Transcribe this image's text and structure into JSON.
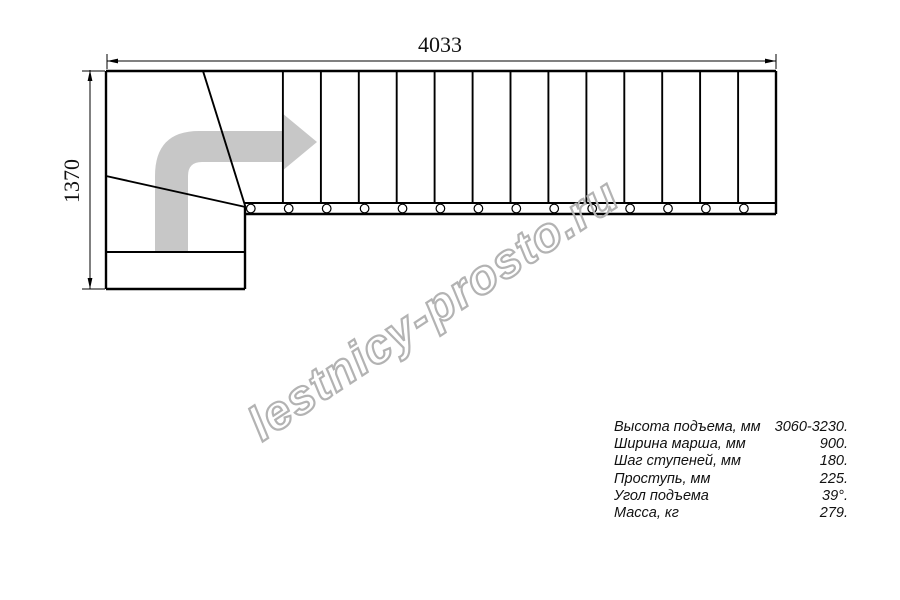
{
  "drawing": {
    "dim_width_label": "4033",
    "dim_height_label": "1370",
    "straight_steps": 14,
    "winder_steps": 3,
    "line_color": "#000000",
    "arrow_color": "#c7c7c7"
  },
  "watermark": {
    "text": "lestnicy-prosto.ru",
    "color": "#b3b3b3"
  },
  "specs": {
    "rows": [
      {
        "label": "Высота подъема, мм",
        "value": "3060-3230."
      },
      {
        "label": "Ширина марша, мм",
        "value": "900."
      },
      {
        "label": "Шаг ступеней, мм",
        "value": "180."
      },
      {
        "label": "Проступь, мм",
        "value": "225."
      },
      {
        "label": "Угол подъема",
        "value": "39°."
      },
      {
        "label": "Масса, кг",
        "value": "279."
      }
    ]
  }
}
